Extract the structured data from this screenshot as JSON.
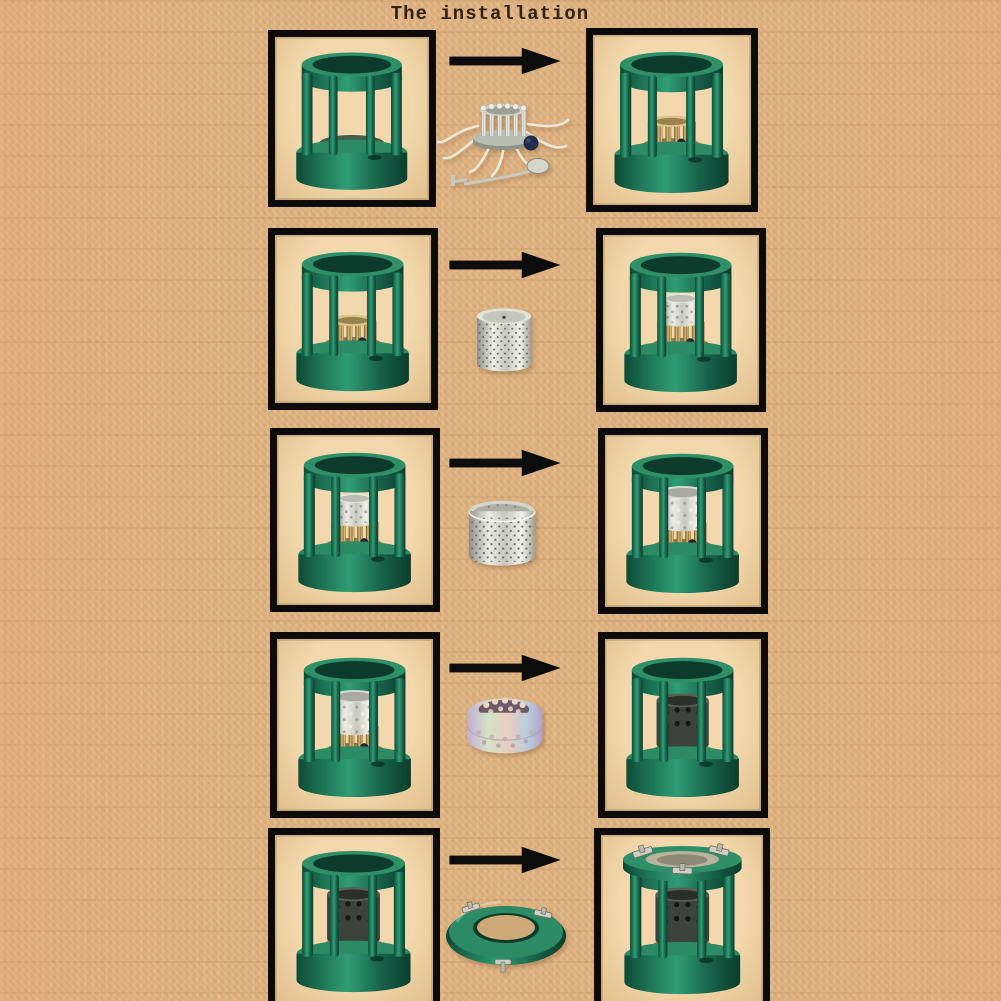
{
  "title": "The installation",
  "colors": {
    "background": "#ddb07e",
    "photo_background": "#eed3a6",
    "box_border": "#0d0b08",
    "stove_green": "#1f7a58",
    "arrow_black": "#0c0c0c",
    "metal_silver": "#d8d8d0",
    "metal_brass": "#c7a55e",
    "ring_iridescent": "#cfc0d8"
  },
  "steps": [
    {
      "index": 1,
      "before": "empty green stove frame (tank base, pillars, top ring)",
      "part": "wick burner unit with splayed white wicks, dark knob and wick-adjust tool",
      "after": "stove frame with wick burner installed"
    },
    {
      "index": 2,
      "before": "stove with wick burner installed",
      "part": "closed perforated inner wick sleeve (silver cup with center hole)",
      "after": "stove with inner perforated sleeve seated over burner"
    },
    {
      "index": 3,
      "before": "stove with inner perforated sleeve",
      "part": "open perforated outer cylinder (silver flame screen)",
      "after": "stove with outer perforated cylinder installed"
    },
    {
      "index": 4,
      "before": "stove with outer perforated cylinder",
      "part": "iridescent flame spreader ring with large holes",
      "after": "stove with flame spreader ring installed (dark burner drum visible)"
    },
    {
      "index": 5,
      "before": "stove with flame spreader ring installed",
      "part": "green top ring / pot support with three metal clips",
      "after": "fully assembled stove with clipped-on top ring"
    }
  ]
}
